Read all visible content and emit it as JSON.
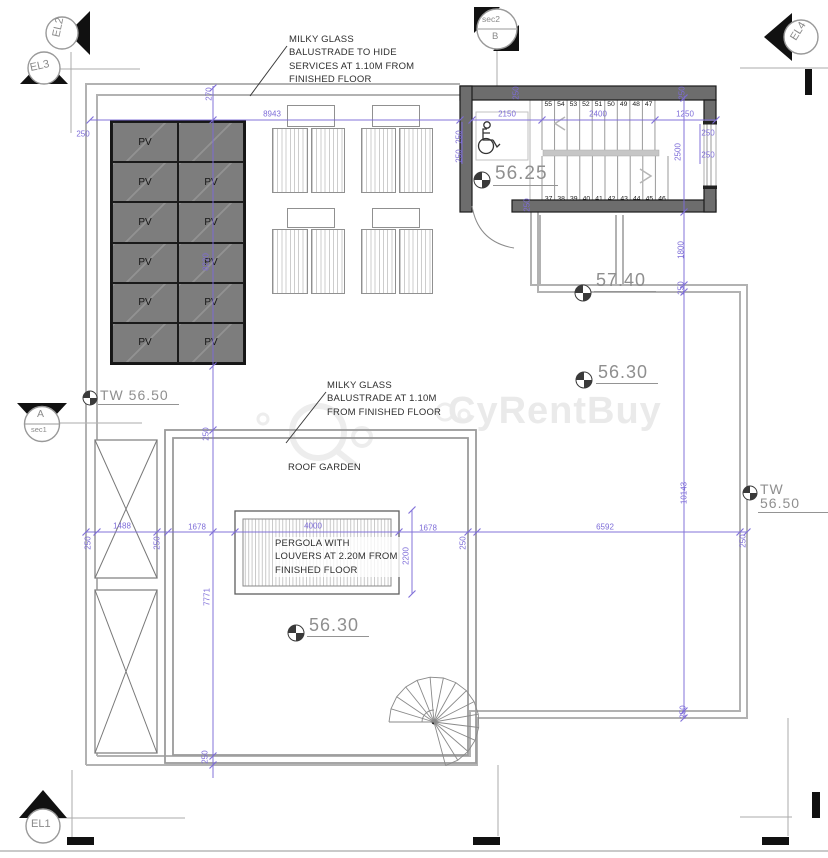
{
  "drawing": {
    "watermark": "CyRentBuy",
    "notes": [
      {
        "id": "note-balustrade-services",
        "text": "MILKY GLASS\nBALUSTRADE TO HIDE\nSERVICES AT 1.10M FROM\nFINISHED FLOOR",
        "x": 289,
        "y": 33,
        "bg": false
      },
      {
        "id": "note-balustrade-garden",
        "text": "MILKY GLASS\nBALUSTRADE  AT 1.10M\nFROM FINISHED FLOOR",
        "x": 327,
        "y": 379,
        "bg": false
      },
      {
        "id": "note-roof-garden",
        "text": "ROOF GARDEN",
        "x": 288,
        "y": 461,
        "bg": false
      },
      {
        "id": "note-pergola",
        "text": "PERGOLA WITH\nLOUVERS  AT 2.20M FROM\nFINISHED FLOOR",
        "x": 273,
        "y": 537,
        "bg": true
      }
    ],
    "levels": [
      {
        "id": "level-stair-landing",
        "text": "56.25",
        "x": 493,
        "y": 164,
        "sx": 482,
        "sy": 180,
        "r": 8,
        "size": 19
      },
      {
        "id": "level-upper-terrace",
        "text": "57.40",
        "x": 594,
        "y": 271,
        "sx": 583,
        "sy": 293,
        "r": 8,
        "size": 18
      },
      {
        "id": "level-right-roof",
        "text": "56.30",
        "x": 596,
        "y": 363,
        "sx": 584,
        "sy": 380,
        "r": 8,
        "size": 18
      },
      {
        "id": "level-roof-garden",
        "text": "56.30",
        "x": 307,
        "y": 616,
        "sx": 296,
        "sy": 633,
        "r": 8,
        "size": 18
      },
      {
        "id": "level-tw-left",
        "text": "TW  56.50",
        "x": 98,
        "y": 388,
        "sx": 90,
        "sy": 398,
        "r": 7,
        "size": 14
      },
      {
        "id": "level-tw-right",
        "text": "TW  56.50",
        "x": 758,
        "y": 482,
        "sx": 750,
        "sy": 493,
        "r": 7,
        "size": 14
      }
    ],
    "markers": {
      "el1": {
        "label": "EL1"
      },
      "el2": {
        "label": "EL2"
      },
      "el3": {
        "label": "EL3"
      },
      "el4": {
        "label": "EL4"
      },
      "secA": {
        "top": "A",
        "bottom": "sec1"
      },
      "secB": {
        "top": "sec2",
        "bottom": "B"
      }
    },
    "pv": {
      "label": "PV"
    },
    "stairs": {
      "upper": [
        "55",
        "54",
        "53",
        "52",
        "51",
        "50",
        "49",
        "48",
        "47"
      ],
      "lower": [
        "37",
        "38",
        "39",
        "40",
        "41",
        "42",
        "43",
        "44",
        "45",
        "46"
      ]
    },
    "dims": [
      {
        "t": "8943",
        "x": 272,
        "y": 114
      },
      {
        "t": "270",
        "x": 209,
        "y": 94,
        "r": 1
      },
      {
        "t": "250",
        "x": 83,
        "y": 134
      },
      {
        "t": "2150",
        "x": 507,
        "y": 114
      },
      {
        "t": "2400",
        "x": 598,
        "y": 114
      },
      {
        "t": "1250",
        "x": 685,
        "y": 114
      },
      {
        "t": "250",
        "x": 459,
        "y": 137,
        "r": 1
      },
      {
        "t": "250",
        "x": 459,
        "y": 156,
        "r": 1
      },
      {
        "t": "250",
        "x": 708,
        "y": 133
      },
      {
        "t": "250",
        "x": 708,
        "y": 155
      },
      {
        "t": "2500",
        "x": 678,
        "y": 152,
        "r": 1
      },
      {
        "t": "250",
        "x": 516,
        "y": 93,
        "r": 1
      },
      {
        "t": "250",
        "x": 682,
        "y": 93,
        "r": 1
      },
      {
        "t": "250",
        "x": 527,
        "y": 205,
        "r": 1
      },
      {
        "t": "1800",
        "x": 681,
        "y": 250,
        "r": 1
      },
      {
        "t": "250",
        "x": 681,
        "y": 288,
        "r": 1
      },
      {
        "t": "8220",
        "x": 206,
        "y": 262,
        "r": 1
      },
      {
        "t": "250",
        "x": 206,
        "y": 434,
        "r": 1
      },
      {
        "t": "1488",
        "x": 122,
        "y": 526
      },
      {
        "t": "250",
        "x": 88,
        "y": 543,
        "r": 1
      },
      {
        "t": "250",
        "x": 157,
        "y": 543,
        "r": 1
      },
      {
        "t": "1678",
        "x": 197,
        "y": 527
      },
      {
        "t": "4000",
        "x": 313,
        "y": 526
      },
      {
        "t": "1678",
        "x": 428,
        "y": 528
      },
      {
        "t": "250",
        "x": 463,
        "y": 543,
        "r": 1
      },
      {
        "t": "6592",
        "x": 605,
        "y": 527
      },
      {
        "t": "250",
        "x": 743,
        "y": 541,
        "r": 1
      },
      {
        "t": "2200",
        "x": 406,
        "y": 556,
        "r": 1
      },
      {
        "t": "7771",
        "x": 207,
        "y": 597,
        "r": 1
      },
      {
        "t": "250",
        "x": 205,
        "y": 757,
        "r": 1
      },
      {
        "t": "10143",
        "x": 684,
        "y": 493,
        "r": 1
      },
      {
        "t": "250",
        "x": 683,
        "y": 712,
        "r": 1
      }
    ]
  }
}
